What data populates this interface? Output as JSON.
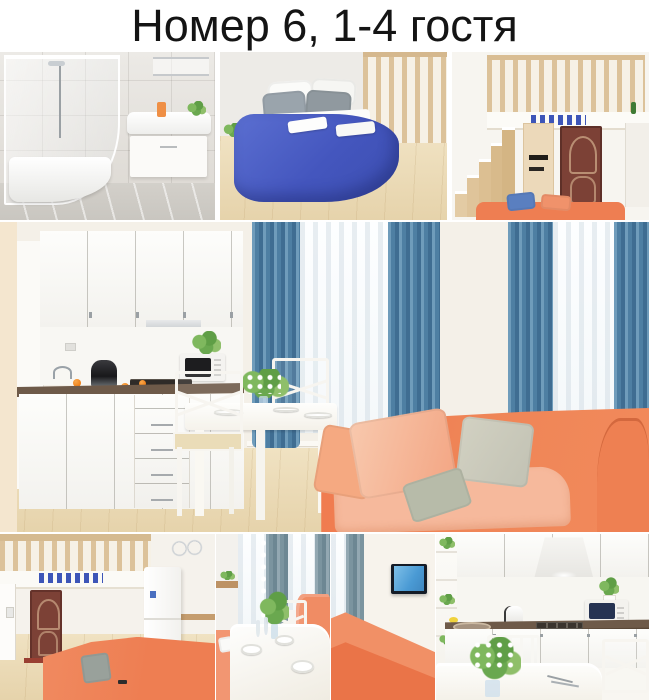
{
  "title": "Номер 6, 1-4 гостя",
  "photos": [
    {
      "id": "bathroom",
      "description": "Ванная: угловая душевая кабина, белая раковина с тумбой, оранжевый флакон, зелёное растение, серая плитка"
    },
    {
      "id": "bedroom",
      "description": "Спальня: кровать с синим покрывалом, серые и белые подушки, белые полотенца, деревянные перила, светлый пол"
    },
    {
      "id": "loft-stairs",
      "description": "Студия с антресолью: деревянная лестница, перила антресоли, коричневая входная дверь, шкаф, коралловый диван"
    },
    {
      "id": "kitchen-living",
      "description": "Кухня-гостиная: белый кухонный гарнитур, тёмная столешница, микроволновка, обеденный стол с белыми стульями и цветами, два окна с синими шторами, коралловый диван с подушками"
    },
    {
      "id": "loft-hall",
      "description": "Прихожая под антресолью: перила, коричневая дверь, белый холодильник, коралловый диван с серой подушкой"
    },
    {
      "id": "dining",
      "description": "Обеденная зона: белый стол с посудой и цветами, стул с крестовой спинкой, серо-голубые шторы, коралловый диван"
    },
    {
      "id": "sofa-tv",
      "description": "Гостиная: спинка кораллового дивана, телевизор на стене, голубая штора"
    },
    {
      "id": "kitchen-table",
      "description": "Кухня: белые шкафы, вытяжка, плита, чайник, микроволновка, мойка, белый обеденный стол с букетом и приборами"
    }
  ],
  "colors": {
    "page_bg": "#ffffff",
    "title_text": "#141414",
    "coral": "#ee7e52",
    "coral_light": "#f6b99c",
    "peach": "#f5a981",
    "blue_bed": "#4a5ec6",
    "curtain_blue": "#4e7fa3",
    "curtain_gray": "#7b949f",
    "wood_floor": "#ecdcba",
    "wood_rail": "#dcc29a",
    "counter": "#6e5a49",
    "door": "#7c4136",
    "wall": "#f4f0e8",
    "tile_gray": "#dcd8d2",
    "green": "#5f9e46",
    "orange": "#ee7f18",
    "pillow_gray": "#c2c2b4",
    "tv_screen": "#4a9ad4"
  }
}
